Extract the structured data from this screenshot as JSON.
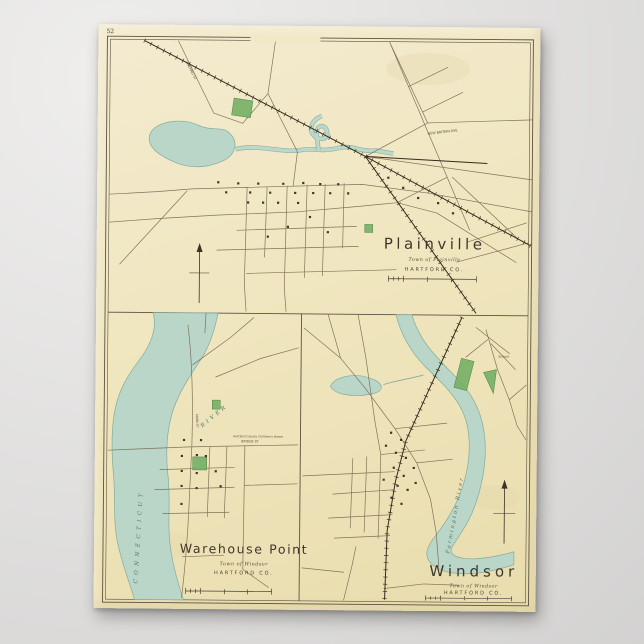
{
  "page_number": "52",
  "panels": {
    "plainville": {
      "title": "Plainville",
      "subtitle": "Town of Plainville",
      "county": "HARTFORD CO."
    },
    "warehouse_point": {
      "title": "Warehouse Point",
      "subtitle": "Town of Windsor",
      "county": "HARTFORD CO."
    },
    "windsor": {
      "title": "Windsor",
      "subtitle": "Town of Windsor",
      "county": "HARTFORD CO."
    }
  },
  "map_labels": {
    "connecticut": "CONNECTICUT",
    "river": "RIVER",
    "farmington_river": "Farmington River",
    "whiting_st": "WHITING ST",
    "new_britain_ave": "NEW BRITAIN AVE",
    "main_st": "MAIN ST",
    "bridge_st": "BRIDGE ST",
    "school": "School",
    "childrens_home": "Hartford County Children's Home"
  },
  "colors": {
    "paper": "#f0e6bf",
    "backdrop": "#dededd",
    "water": "#b9d6c9",
    "water_edge": "#84ab9c",
    "park_green": "#76b065",
    "road_ink": "#7a6950",
    "rail_ink": "#342b1d",
    "text_ink": "#3d372b"
  }
}
